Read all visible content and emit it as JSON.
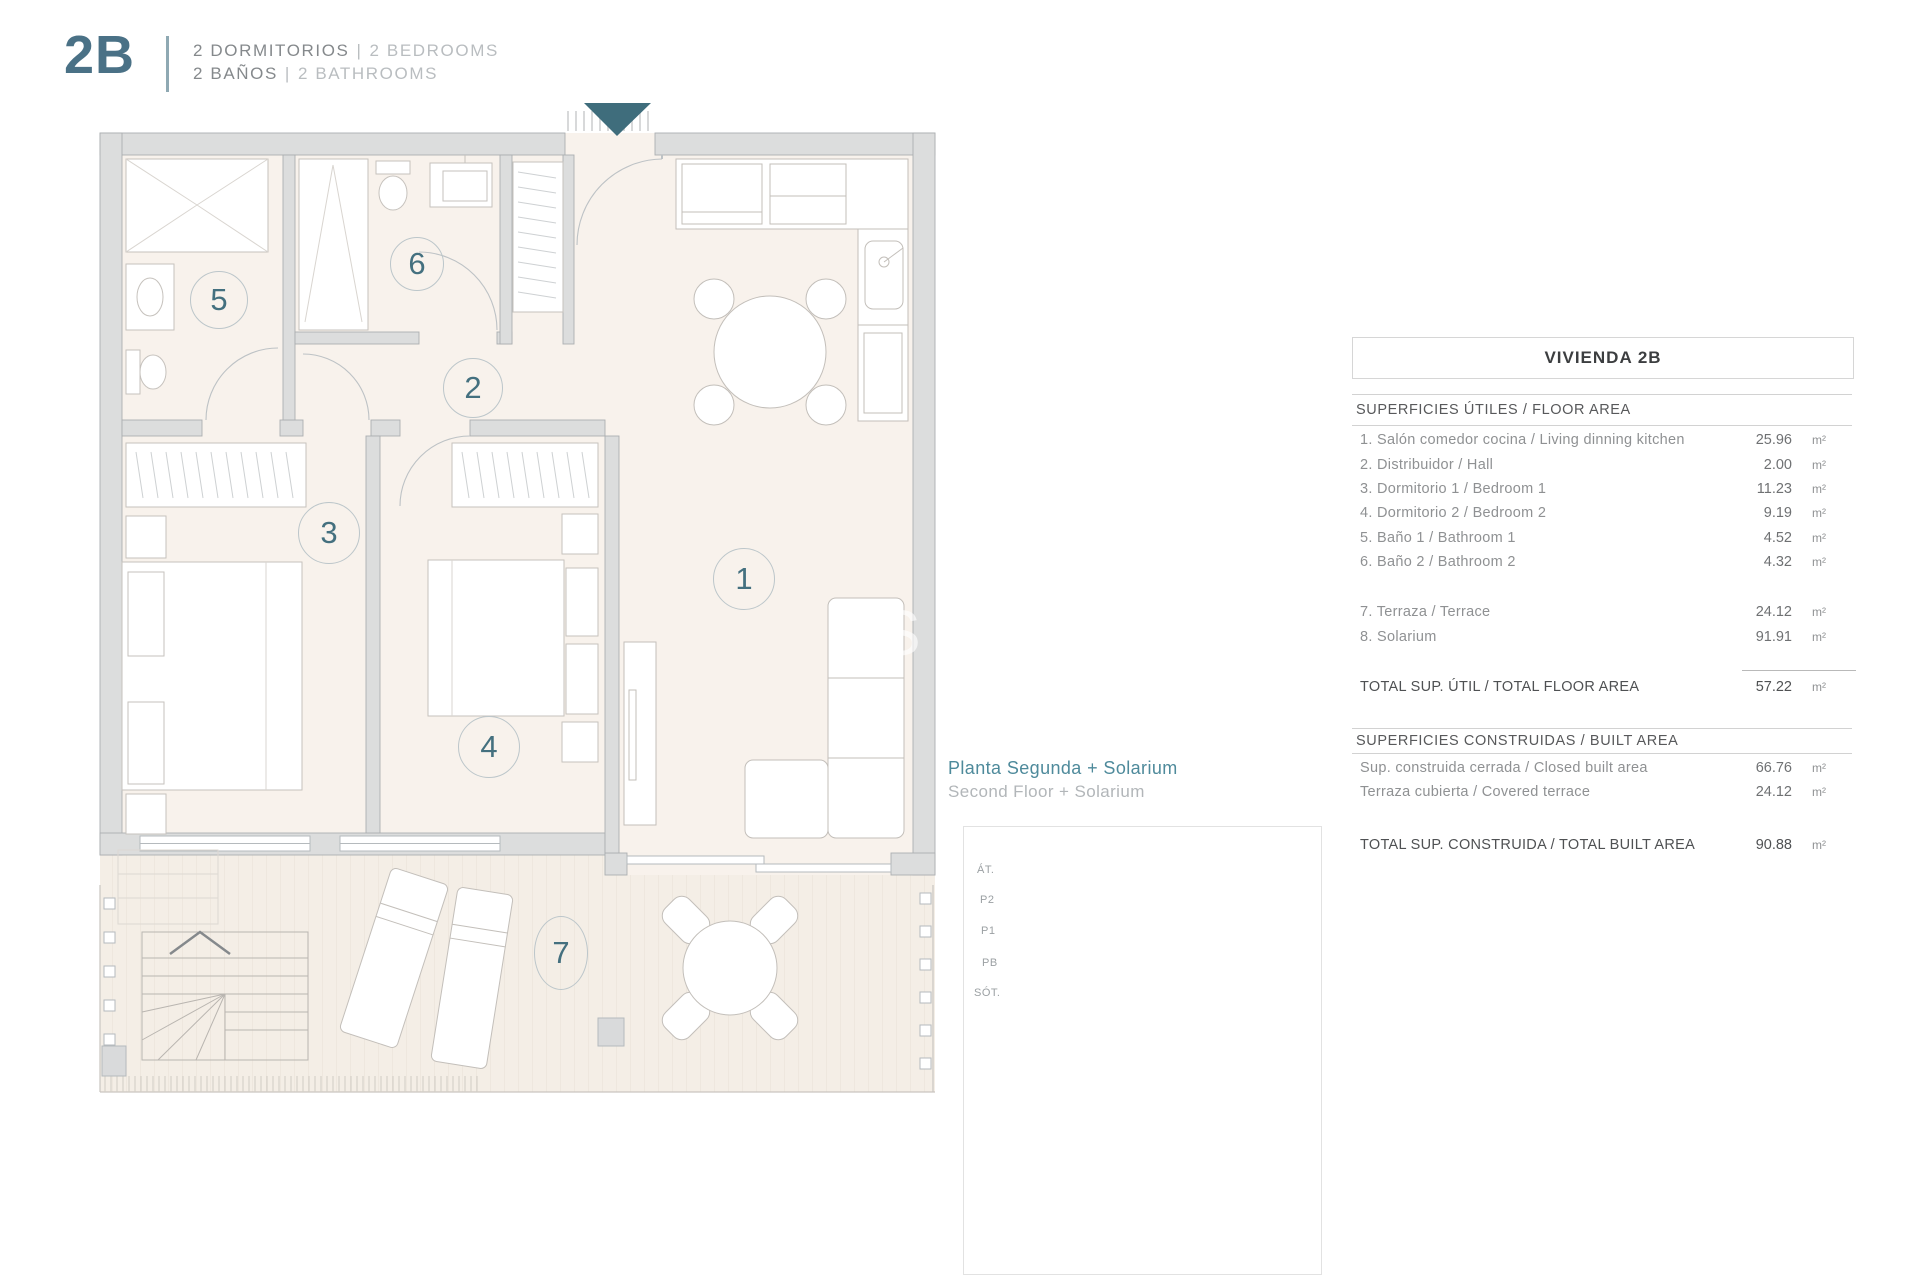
{
  "header": {
    "unit": "2B",
    "line1": {
      "es": "2 DORMITORIOS",
      "sep": "|",
      "en": "2 BEDROOMS"
    },
    "line2": {
      "es": "2 BAÑOS",
      "sep": "|",
      "en": "2 BATHROOMS"
    }
  },
  "plan": {
    "rooms": [
      {
        "number": "1"
      },
      {
        "number": "2"
      },
      {
        "number": "3"
      },
      {
        "number": "4"
      },
      {
        "number": "5"
      },
      {
        "number": "6"
      },
      {
        "number": "7"
      }
    ],
    "watermark": "S"
  },
  "planta": {
    "es": "Planta Segunda + Solarium",
    "en": "Second Floor + Solarium"
  },
  "elevation": {
    "labels": [
      "ÁT.",
      "P2",
      "P1",
      "PB",
      "SÓT."
    ]
  },
  "table": {
    "title": "VIVIENDA 2B",
    "floor_section": "SUPERFICIES ÚTILES / FLOOR AREA",
    "floor_rows": [
      {
        "label": "1. Salón comedor cocina / Living dinning kitchen",
        "value": "25.96",
        "unit": "m²"
      },
      {
        "label": "2. Distribuidor / Hall",
        "value": "2.00",
        "unit": "m²"
      },
      {
        "label": "3. Dormitorio 1 / Bedroom 1",
        "value": "11.23",
        "unit": "m²"
      },
      {
        "label": "4. Dormitorio 2 / Bedroom 2",
        "value": "9.19",
        "unit": "m²"
      },
      {
        "label": "5. Baño 1 / Bathroom 1",
        "value": "4.52",
        "unit": "m²"
      },
      {
        "label": "6. Baño 2 / Bathroom 2",
        "value": "4.32",
        "unit": "m²"
      },
      {
        "label": "7. Terraza / Terrace",
        "value": "24.12",
        "unit": "m²"
      },
      {
        "label": "8. Solarium",
        "value": "91.91",
        "unit": "m²"
      }
    ],
    "floor_total": {
      "label": "TOTAL SUP. ÚTIL / TOTAL FLOOR AREA",
      "value": "57.22",
      "unit": "m²"
    },
    "built_section": "SUPERFICIES CONSTRUIDAS / BUILT AREA",
    "built_rows": [
      {
        "label": "Sup. construida cerrada / Closed built area",
        "value": "66.76",
        "unit": "m²"
      },
      {
        "label": "Terraza cubierta / Covered terrace",
        "value": "24.12",
        "unit": "m²"
      }
    ],
    "built_total": {
      "label": "TOTAL SUP. CONSTRUIDA /  TOTAL BUILT AREA",
      "value": "90.88",
      "unit": "m²"
    }
  },
  "colors": {
    "accent_teal": "#4a7186",
    "plan_highlight": "#7fa3b2",
    "entrance_arrow": "#3f6d7c"
  }
}
